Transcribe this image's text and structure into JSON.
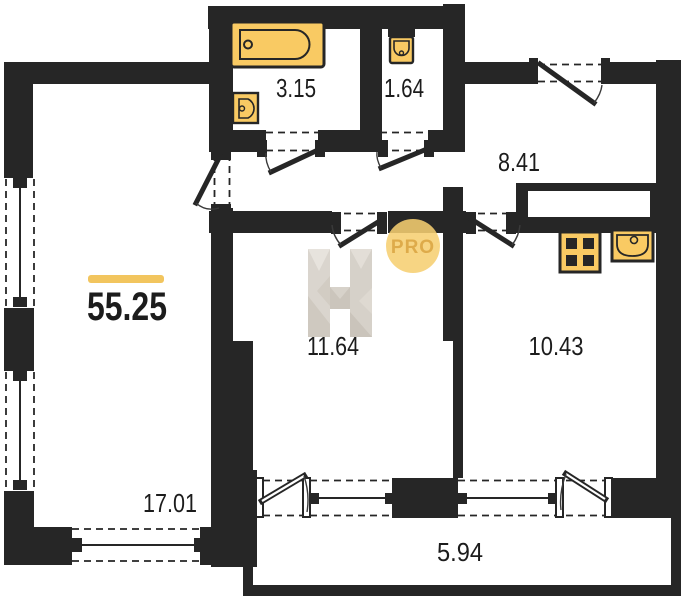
{
  "plan": {
    "total_area": "55.25",
    "rooms": [
      {
        "name": "bathroom",
        "area": "3.15"
      },
      {
        "name": "toilet",
        "area": "1.64"
      },
      {
        "name": "hallway",
        "area": "8.41"
      },
      {
        "name": "room",
        "area": "11.64"
      },
      {
        "name": "kitchen",
        "area": "10.43"
      },
      {
        "name": "living-room",
        "area": "17.01"
      },
      {
        "name": "balcony",
        "area": "5.94"
      }
    ],
    "watermark": {
      "badge_label": "PRO"
    },
    "colors": {
      "wall": "#262626",
      "fixture": "#F9CA63",
      "accent": "#F2C55E",
      "badge": "#F6CF70",
      "badge_text": "#D8A13C",
      "ink": "#1C1C1C"
    }
  }
}
